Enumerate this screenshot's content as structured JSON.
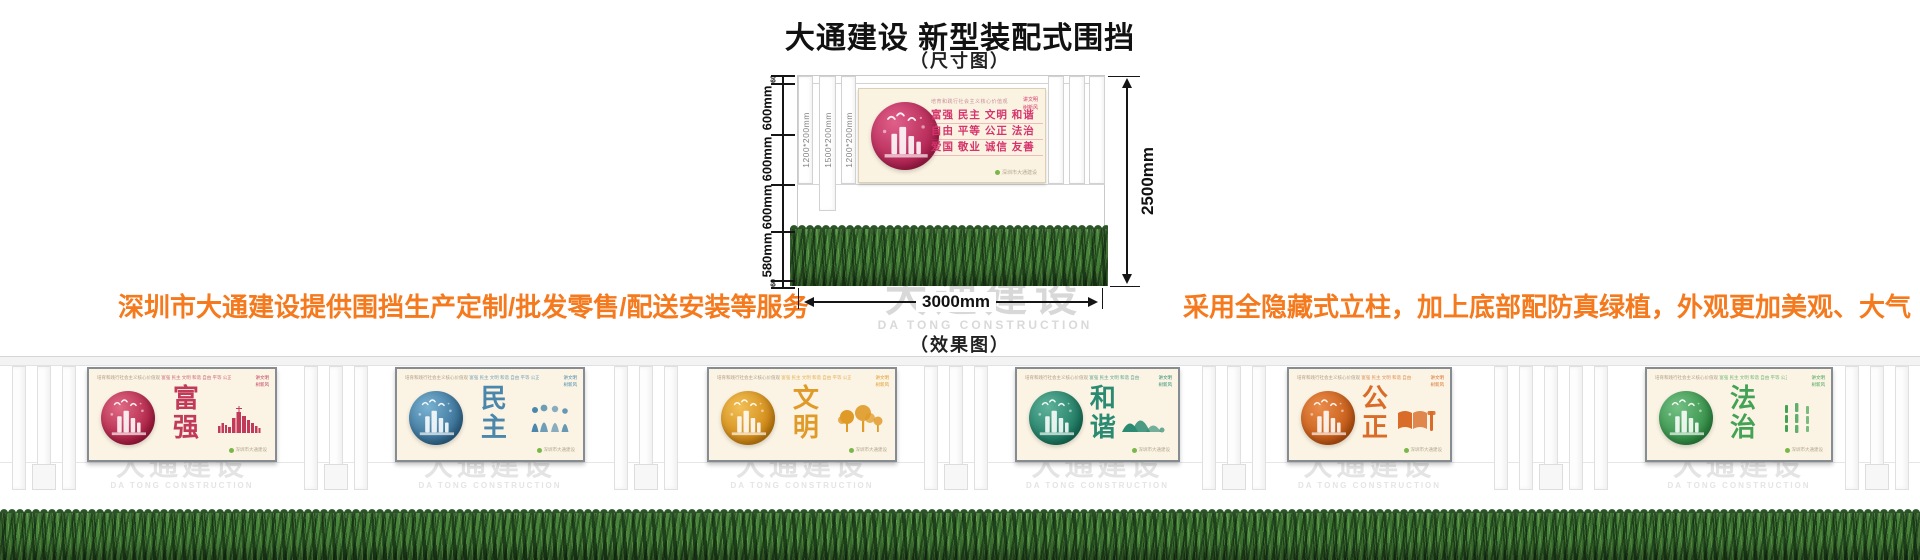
{
  "header": {
    "title": "大通建设 新型装配式围挡",
    "dim_caption": "（尺寸图）",
    "effect_caption": "（效果图）"
  },
  "promo": {
    "left": "深圳市大通建设提供围挡生产定制/批发零售/配送安装等服务",
    "right": "采用全隐藏式立柱，加上底部配防真绿植，外观更加美观、大气",
    "color": "#f5791d"
  },
  "watermark": {
    "cn": "大通建设",
    "en": "DA TONG CONSTRUCTION"
  },
  "dimensions": {
    "total_height": "2500mm",
    "total_width": "3000mm",
    "left_segments": [
      {
        "label": "60"
      },
      {
        "label": "600mm"
      },
      {
        "label": "600mm"
      },
      {
        "label": "600mm"
      },
      {
        "label": "580mm"
      },
      {
        "label": "60"
      }
    ],
    "post_labels": [
      "1200*200mm",
      "1500*200mm",
      "1200*200mm"
    ]
  },
  "values_panel": {
    "slogan": "培育和践行社会主义核心价值观",
    "corner": [
      "讲文明",
      "树新风"
    ],
    "rows": [
      "富强  民主  文明  和谐",
      "自由  平等  公正  法治",
      "爱国  敬业  诚信  友善"
    ],
    "footer": "深圳市大通建设",
    "color": "#d6336c",
    "circle_colors": [
      "#e0608a",
      "#ab1c4b"
    ],
    "dot_color": "#7ab648"
  },
  "effect": {
    "panel_header_slogan": "培育和践行社会主义核心价值观",
    "panel_header_values": "富强 民主 文明 和谐 自由 平等 公正 法治 爱国 敬业 诚信 友善",
    "corner": [
      "讲文明",
      "树新风"
    ],
    "footer": "深圳市大通建设",
    "dot_color": "#7ab648",
    "panels": [
      {
        "title": "富强",
        "color": "#c13a5a",
        "circle": [
          "#e06a85",
          "#a9193f"
        ],
        "motif": "city-skyline-icon"
      },
      {
        "title": "民主",
        "color": "#4b87ab",
        "circle": [
          "#79b2d2",
          "#30688f"
        ],
        "motif": "people-group-icon"
      },
      {
        "title": "文明",
        "color": "#e09a28",
        "circle": [
          "#f2bf55",
          "#cc820e"
        ],
        "motif": "trees-icon"
      },
      {
        "title": "和谐",
        "color": "#2b8a72",
        "circle": [
          "#5fb29a",
          "#16745c"
        ],
        "motif": "mountains-icon"
      },
      {
        "title": "公正",
        "color": "#d96c28",
        "circle": [
          "#eb8c4a",
          "#bf5410"
        ],
        "motif": "book-gavel-icon"
      },
      {
        "title": "法治",
        "color": "#44a257",
        "circle": [
          "#74c084",
          "#2c8a40"
        ],
        "motif": "bamboo-icon"
      }
    ]
  }
}
